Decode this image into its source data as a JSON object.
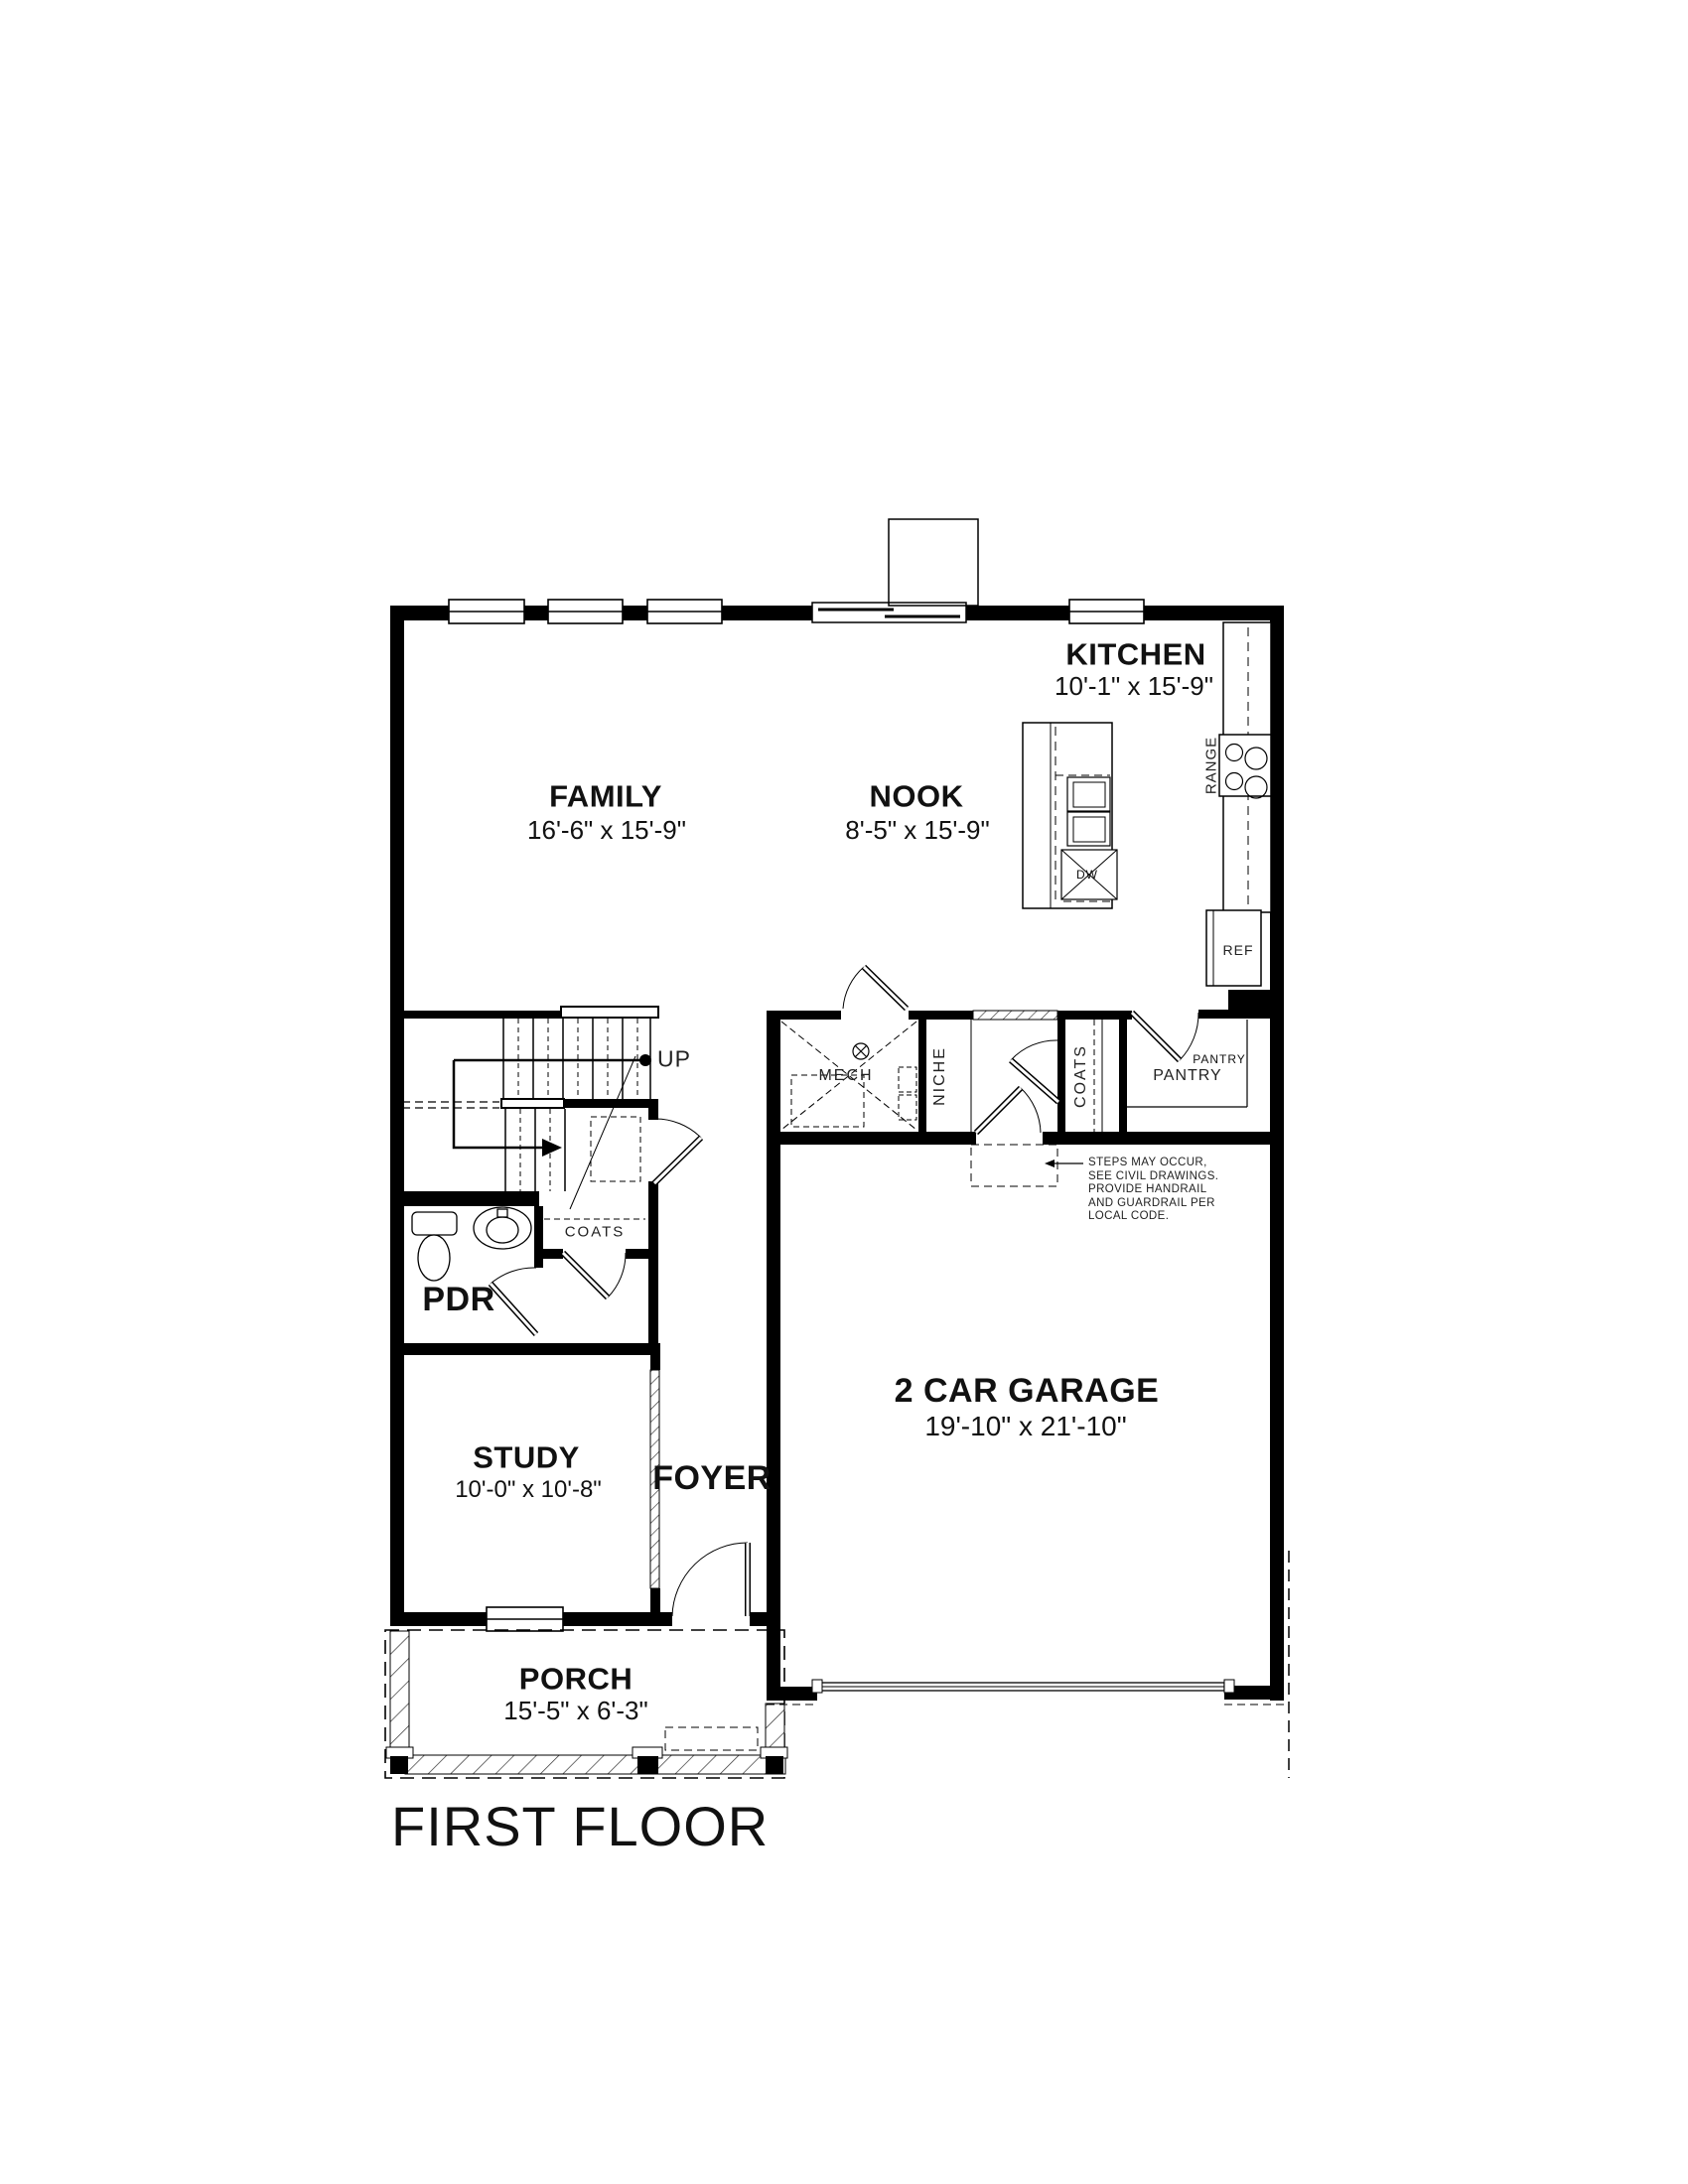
{
  "title": "FIRST FLOOR",
  "rooms": {
    "kitchen": {
      "name": "KITCHEN",
      "dims": "10'-1\" x 15'-9\""
    },
    "family": {
      "name": "FAMILY",
      "dims": "16'-6\" x 15'-9\""
    },
    "nook": {
      "name": "NOOK",
      "dims": "8'-5\" x 15'-9\""
    },
    "garage": {
      "name": "2 CAR GARAGE",
      "dims": "19'-10\" x 21'-10\""
    },
    "study": {
      "name": "STUDY",
      "dims": "10'-0\" x 10'-8\""
    },
    "foyer": {
      "name": "FOYER"
    },
    "porch": {
      "name": "PORCH",
      "dims": "15'-5\" x 6'-3\""
    },
    "powder": {
      "name": "PDR"
    }
  },
  "closets": {
    "mech": "MECH",
    "niche": "NICHE",
    "coats_mudroom": "COATS",
    "coats_hall": "COATS",
    "pantry_callout": "PANTRY",
    "pantry": "PANTRY"
  },
  "fixtures": {
    "range": "RANGE",
    "dishwasher": "DW",
    "refrigerator": "REF"
  },
  "stairs": {
    "direction": "UP"
  },
  "note": "STEPS MAY OCCUR,\nSEE CIVIL DRAWINGS.\nPROVIDE HANDRAIL\nAND GUARDRAIL PER\nLOCAL CODE."
}
